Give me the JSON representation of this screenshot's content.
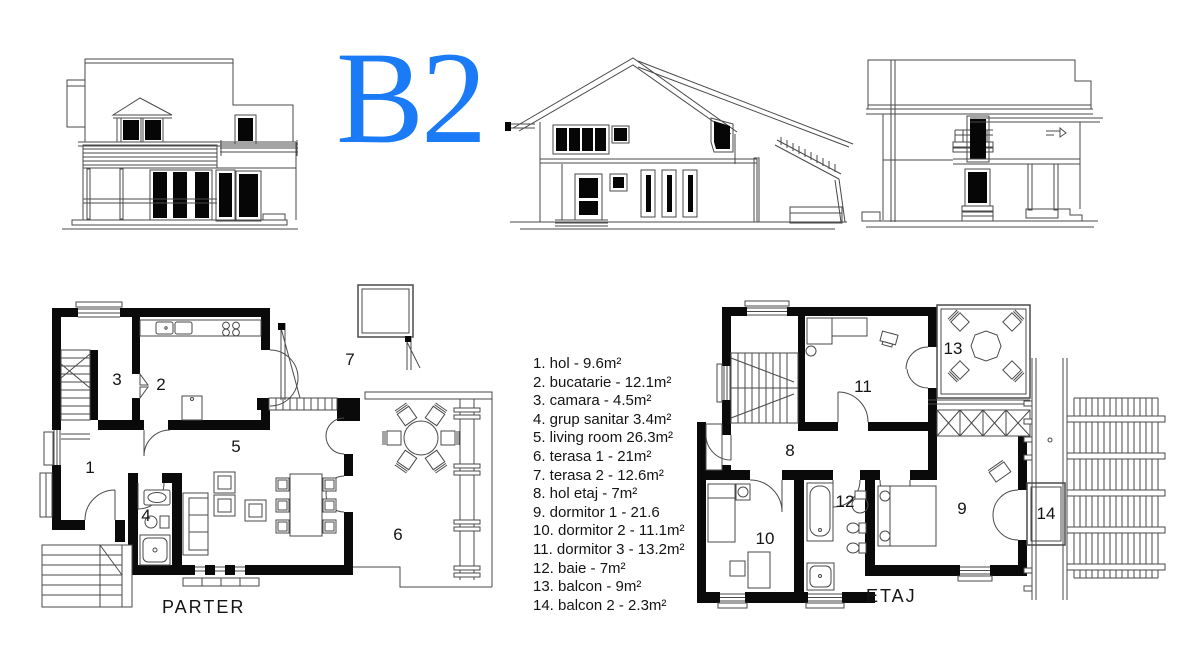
{
  "title": {
    "text": "B2",
    "color": "#1b7af5"
  },
  "legend": {
    "items": [
      "1. hol - 9.6m²",
      "2. bucatarie - 12.1m²",
      "3. camara - 4.5m²",
      "4. grup sanitar 3.4m²",
      "5. living room 26.3m²",
      "6. terasa 1 - 21m²",
      "7. terasa 2 - 12.6m²",
      "8. hol etaj - 7m²",
      "9. dormitor 1 - 21.6",
      "10. dormitor 2 - 11.1m²",
      "11. dormitor 3 - 13.2m²",
      "12. baie - 7m²",
      "13. balcon - 9m²",
      "14. balcon 2 - 2.3m²"
    ]
  },
  "plans": {
    "parter": {
      "label": "PARTER",
      "rooms": [
        "1",
        "2",
        "3",
        "4",
        "5",
        "6",
        "7"
      ]
    },
    "etaj": {
      "label": "ETAJ",
      "rooms": [
        "8",
        "9",
        "10",
        "11",
        "12",
        "13",
        "14"
      ]
    }
  },
  "colors": {
    "walls": "#0a0a0a",
    "lines": "#4a4a4a",
    "background": "#ffffff"
  }
}
